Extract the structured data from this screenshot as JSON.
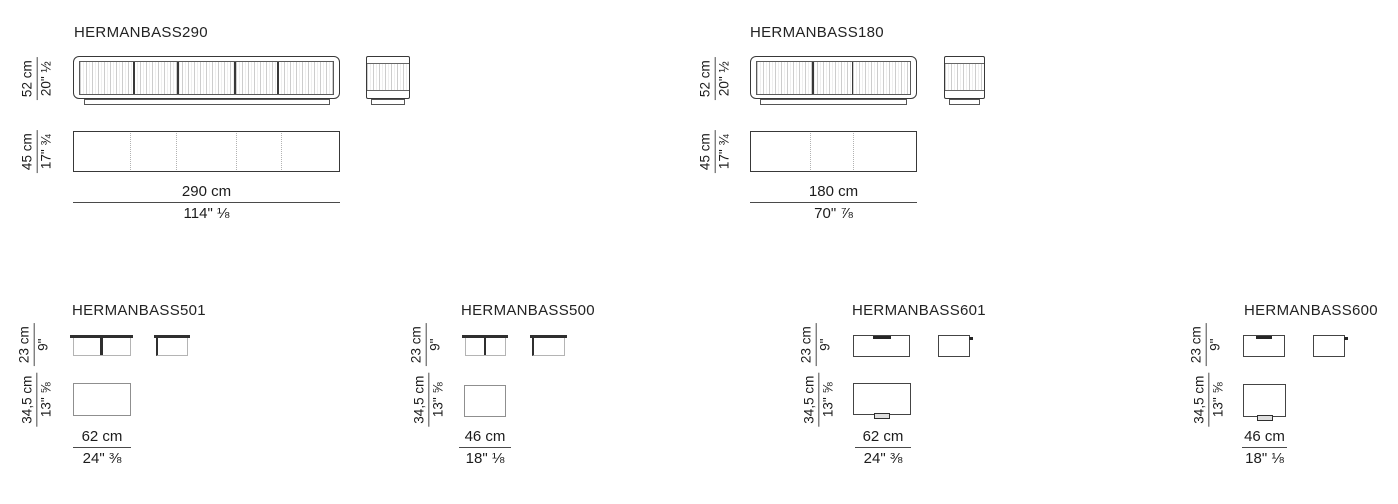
{
  "diagram": {
    "colors": {
      "background": "#ffffff",
      "line": "#383838",
      "light_line": "#b2b2b2",
      "text": "#1c1c1c"
    },
    "products": [
      {
        "model": "HERMANBASS290",
        "height_cm": "52 cm",
        "height_in": "20\" ½",
        "depth_cm": "45 cm",
        "depth_in": "17\" ¾",
        "width_cm": "290 cm",
        "width_in": "114\" ⅛"
      },
      {
        "model": "HERMANBASS180",
        "height_cm": "52 cm",
        "height_in": "20\" ½",
        "depth_cm": "45 cm",
        "depth_in": "17\" ¾",
        "width_cm": "180 cm",
        "width_in": "70\" ⅞"
      },
      {
        "model": "HERMANBASS501",
        "height_cm": "23 cm",
        "height_in": "9\"",
        "depth_cm": "34,5 cm",
        "depth_in": "13\" ⅝",
        "width_cm": "62 cm",
        "width_in": "24\" ⅜"
      },
      {
        "model": "HERMANBASS500",
        "height_cm": "23 cm",
        "height_in": "9\"",
        "depth_cm": "34,5 cm",
        "depth_in": "13\" ⅝",
        "width_cm": "46 cm",
        "width_in": "18\" ⅛"
      },
      {
        "model": "HERMANBASS601",
        "height_cm": "23 cm",
        "height_in": "9\"",
        "depth_cm": "34,5 cm",
        "depth_in": "13\" ⅝",
        "width_cm": "62 cm",
        "width_in": "24\" ⅜"
      },
      {
        "model": "HERMANBASS600",
        "height_cm": "23 cm",
        "height_in": "9\"",
        "depth_cm": "34,5 cm",
        "depth_in": "13\" ⅝",
        "width_cm": "46 cm",
        "width_in": "18\" ⅛"
      }
    ]
  }
}
